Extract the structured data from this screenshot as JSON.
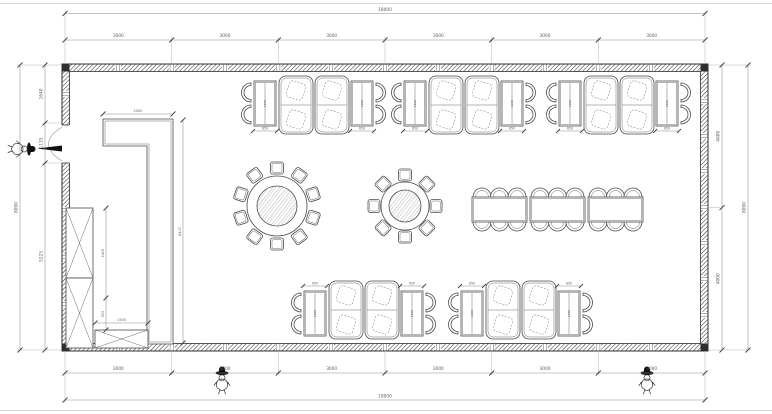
{
  "document": {
    "type": "CAD floor plan",
    "title": "Restaurant dining room furniture layout plan",
    "units": "mm"
  },
  "dimensions": {
    "top": {
      "total": "18000",
      "segments": [
        "3000",
        "3000",
        "3000",
        "3000",
        "3000",
        "3000"
      ]
    },
    "bottom": {
      "total": "18000",
      "segments": [
        "3000",
        "3000",
        "3000",
        "3000",
        "3000",
        "3000"
      ]
    },
    "left": {
      "total": "8000",
      "segments": [
        "1640",
        "1135",
        "5225"
      ]
    },
    "right": {
      "total": "8000",
      "segments": [
        "4000",
        "4000"
      ]
    },
    "interior": {
      "counter_length": "2000",
      "counter_run": "6400",
      "cabinet_upper": "2425",
      "cabinet_lower": "900",
      "low_cabinet_width": "1500",
      "booth_table_width": "650",
      "booth_table_length": "1200"
    }
  },
  "furniture": {
    "round_table_large": {
      "label": "round-table-10-seats",
      "chairs": 10
    },
    "round_table_small": {
      "label": "round-table-8-seats",
      "chairs": 8
    },
    "banquet": {
      "tables": 3,
      "chairs_per_side": 3
    },
    "booth_groups_top": 3,
    "booth_groups_bottom": 2,
    "tall_cabinets": 2,
    "low_cabinets": 1
  },
  "symbols": {
    "door": "left-swing-door",
    "figures": [
      "left-entry-figure",
      "bottom-figure-1",
      "bottom-figure-2"
    ]
  },
  "colors": {
    "line": "#4a4a4a",
    "wall": "#2f2f2f",
    "dim": "#8a8a8a",
    "text": "#5d5d5d",
    "background": "#ffffff",
    "accent_black": "#111111"
  }
}
